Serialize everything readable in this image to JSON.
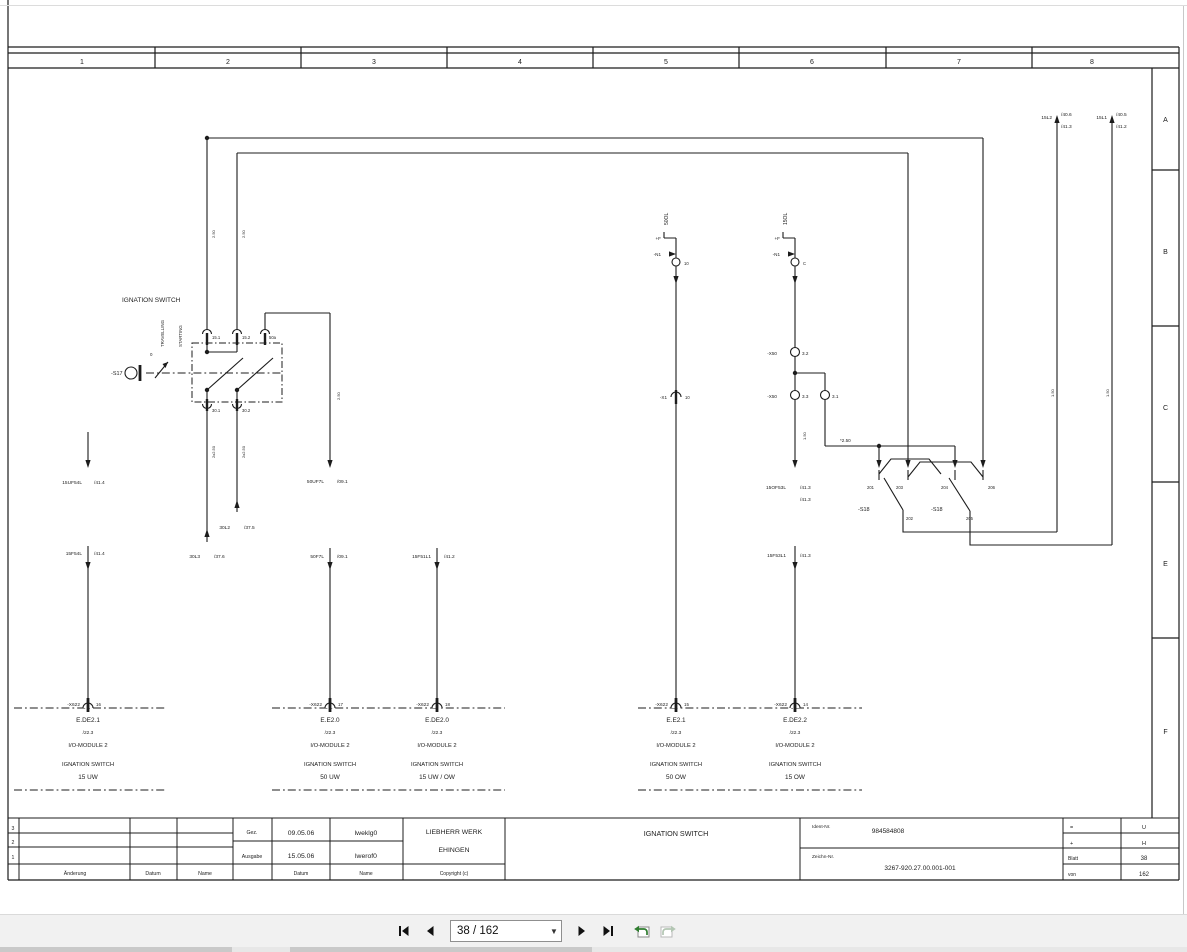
{
  "viewer": {
    "page_field": "38 / 162",
    "first_page": "first page",
    "previous_page": "previous page",
    "next_page": "next page",
    "last_page": "last page",
    "previous_view": "previous view",
    "next_view": "next view"
  },
  "frame": {
    "columns": [
      "1",
      "2",
      "3",
      "4",
      "5",
      "6",
      "7",
      "8"
    ],
    "rows": [
      "A",
      "B",
      "C",
      "E",
      "F"
    ]
  },
  "title_block": {
    "revision_rows": [
      "3",
      "2",
      "1"
    ],
    "headers": {
      "aenderung": "Änderung",
      "datum": "Datum",
      "name": "Name"
    },
    "created": {
      "label": "Gez.",
      "date": "09.05.06",
      "name": "lweklg0"
    },
    "issued": {
      "label": "Ausgabe",
      "date": "15.05.06",
      "name": "lwerof0"
    },
    "footer": {
      "datum": "Datum",
      "name": "Name",
      "copyright": "Copyright (c)"
    },
    "company": [
      "LIEBHERR WERK",
      "EHINGEN"
    ],
    "title": "IGNATION SWITCH",
    "ident": {
      "label": "Ident-Nr.",
      "value": "984584808"
    },
    "zeichn": {
      "label": "Zeichn-Nr.",
      "value": "3267-920.27.00.001-001"
    },
    "meta": [
      [
        "=",
        "U"
      ],
      [
        "+",
        "H"
      ],
      [
        "Blatt",
        "38"
      ],
      [
        "von",
        "162"
      ]
    ]
  },
  "schematic": {
    "labels": [
      {
        "n": "ignition-switch-caption",
        "t": "IGNATION SWITCH",
        "x": 122,
        "y": 302,
        "a": "l",
        "s": 6.5
      },
      {
        "n": "travelling-label",
        "t": "TRAVELLING",
        "x": 164,
        "y": 347,
        "a": "l",
        "s": 4.4,
        "r": 1
      },
      {
        "n": "starting-label",
        "t": "STARTING",
        "x": 182,
        "y": 347,
        "a": "l",
        "s": 4.4,
        "r": 1
      },
      {
        "n": "position-0-label",
        "t": "0",
        "x": 150,
        "y": 356,
        "a": "l",
        "s": 4.4
      },
      {
        "n": "s17-label",
        "t": "-S17",
        "x": 111,
        "y": 375,
        "a": "l",
        "s": 5.5
      },
      {
        "t": "15.1",
        "x": 212,
        "y": 339,
        "a": "l",
        "s": 4.2
      },
      {
        "t": "15.2",
        "x": 242,
        "y": 339,
        "a": "l",
        "s": 4.2
      },
      {
        "t": "50a",
        "x": 269,
        "y": 339,
        "a": "l",
        "s": 4.2
      },
      {
        "t": "30.1",
        "x": 212,
        "y": 412,
        "a": "l",
        "s": 4.2
      },
      {
        "t": "30.2",
        "x": 242,
        "y": 412,
        "a": "l",
        "s": 4.2
      },
      {
        "t": "2.50",
        "x": 215,
        "y": 238,
        "a": "l",
        "s": 4,
        "r": 1
      },
      {
        "t": "2.50",
        "x": 245,
        "y": 238,
        "a": "l",
        "s": 4,
        "r": 1
      },
      {
        "t": "2x2.50",
        "x": 215,
        "y": 458,
        "a": "l",
        "s": 4,
        "r": 1
      },
      {
        "t": "2x2.50",
        "x": 245,
        "y": 458,
        "a": "l",
        "s": 4,
        "r": 1
      },
      {
        "t": "2.50",
        "x": 340,
        "y": 400,
        "a": "l",
        "s": 4,
        "r": 1
      },
      {
        "t": "15UF54L",
        "x": 82,
        "y": 484,
        "a": "r",
        "s": 4.8
      },
      {
        "t": "/41.4",
        "x": 94,
        "y": 484,
        "a": "l",
        "s": 4.8
      },
      {
        "t": "15F54L",
        "x": 82,
        "y": 555,
        "a": "r",
        "s": 4.8
      },
      {
        "t": "/41.4",
        "x": 94,
        "y": 555,
        "a": "l",
        "s": 4.8
      },
      {
        "t": "30L2",
        "x": 230,
        "y": 529,
        "a": "r",
        "s": 4.8
      },
      {
        "t": "/37.5",
        "x": 244,
        "y": 529,
        "a": "l",
        "s": 4.8
      },
      {
        "t": "30L3",
        "x": 200,
        "y": 558,
        "a": "r",
        "s": 4.8
      },
      {
        "t": "/37.6",
        "x": 214,
        "y": 558,
        "a": "l",
        "s": 4.8
      },
      {
        "t": "50UF7L",
        "x": 324,
        "y": 483,
        "a": "r",
        "s": 4.8
      },
      {
        "t": "/09.1",
        "x": 337,
        "y": 483,
        "a": "l",
        "s": 4.8
      },
      {
        "t": "50F7L",
        "x": 324,
        "y": 558,
        "a": "r",
        "s": 4.8
      },
      {
        "t": "/09.1",
        "x": 337,
        "y": 558,
        "a": "l",
        "s": 4.8
      },
      {
        "t": "15F51L1",
        "x": 431,
        "y": 558,
        "a": "r",
        "s": 4.8
      },
      {
        "t": "/41.2",
        "x": 444,
        "y": 558,
        "a": "l",
        "s": 4.8
      },
      {
        "n": "wire-50ol",
        "t": "50OL",
        "x": 668,
        "y": 225,
        "a": "l",
        "s": 5,
        "r": 1
      },
      {
        "t": "+F",
        "x": 661,
        "y": 240,
        "a": "r",
        "s": 4.6
      },
      {
        "t": "-N1",
        "x": 661,
        "y": 256,
        "a": "r",
        "s": 4.6
      },
      {
        "t": "10",
        "x": 684,
        "y": 265,
        "a": "l",
        "s": 4.2
      },
      {
        "t": "-X1",
        "x": 667,
        "y": 399,
        "a": "r",
        "s": 4.6
      },
      {
        "t": "10",
        "x": 685,
        "y": 399,
        "a": "l",
        "s": 4.2
      },
      {
        "n": "wire-15ol",
        "t": "15OL",
        "x": 787,
        "y": 225,
        "a": "l",
        "s": 5,
        "r": 1
      },
      {
        "t": "+F",
        "x": 780,
        "y": 240,
        "a": "r",
        "s": 4.6
      },
      {
        "t": "-N1",
        "x": 780,
        "y": 256,
        "a": "r",
        "s": 4.6
      },
      {
        "t": "C",
        "x": 803,
        "y": 265,
        "a": "l",
        "s": 4.2
      },
      {
        "t": "-X50",
        "x": 777,
        "y": 355,
        "a": "r",
        "s": 4.6
      },
      {
        "t": "3.2",
        "x": 802,
        "y": 355,
        "a": "l",
        "s": 4.6
      },
      {
        "t": "-X50",
        "x": 777,
        "y": 398,
        "a": "r",
        "s": 4.6
      },
      {
        "t": "3.3",
        "x": 802,
        "y": 398,
        "a": "l",
        "s": 4.6
      },
      {
        "t": "3.1",
        "x": 832,
        "y": 398,
        "a": "l",
        "s": 4.6
      },
      {
        "t": "1.50",
        "x": 806,
        "y": 440,
        "a": "l",
        "s": 4,
        "r": 1
      },
      {
        "t": "15OF53L",
        "x": 786,
        "y": 489,
        "a": "r",
        "s": 4.8
      },
      {
        "t": "/41.3",
        "x": 800,
        "y": 489,
        "a": "l",
        "s": 4.8
      },
      {
        "t": "/41.3",
        "x": 800,
        "y": 501,
        "a": "l",
        "s": 4.8
      },
      {
        "t": "15F53L1",
        "x": 786,
        "y": 557,
        "a": "r",
        "s": 4.8
      },
      {
        "t": "/41.3",
        "x": 800,
        "y": 557,
        "a": "l",
        "s": 4.8
      },
      {
        "t": "*2.50",
        "x": 840,
        "y": 442,
        "a": "l",
        "s": 4.6
      },
      {
        "t": "201",
        "x": 874,
        "y": 489,
        "a": "r",
        "s": 4.2
      },
      {
        "t": "203",
        "x": 896,
        "y": 489,
        "a": "l",
        "s": 4.2
      },
      {
        "t": "204",
        "x": 941,
        "y": 489,
        "a": "l",
        "s": 4.2
      },
      {
        "t": "206",
        "x": 988,
        "y": 489,
        "a": "l",
        "s": 4.2
      },
      {
        "n": "s18-label",
        "t": "-S18",
        "x": 858,
        "y": 511,
        "a": "l",
        "s": 5.5
      },
      {
        "n": "s18-label",
        "t": "-S18",
        "x": 931,
        "y": 511,
        "a": "l",
        "s": 5.5
      },
      {
        "t": "202",
        "x": 906,
        "y": 520,
        "a": "l",
        "s": 4.2
      },
      {
        "t": "205",
        "x": 966,
        "y": 520,
        "a": "l",
        "s": 4.2
      },
      {
        "t": "15L2",
        "x": 1052,
        "y": 119,
        "a": "r",
        "s": 4.8
      },
      {
        "t": "/40.6",
        "x": 1061,
        "y": 116,
        "a": "l",
        "s": 4.8
      },
      {
        "t": "/41.3",
        "x": 1061,
        "y": 128,
        "a": "l",
        "s": 4.8
      },
      {
        "t": "15L1",
        "x": 1107,
        "y": 119,
        "a": "r",
        "s": 4.8
      },
      {
        "t": "/40.5",
        "x": 1116,
        "y": 116,
        "a": "l",
        "s": 4.8
      },
      {
        "t": "/41.2",
        "x": 1116,
        "y": 128,
        "a": "l",
        "s": 4.8
      },
      {
        "t": "1.50",
        "x": 1054,
        "y": 397,
        "a": "l",
        "s": 4,
        "r": 1
      },
      {
        "t": "1.50",
        "x": 1109,
        "y": 397,
        "a": "l",
        "s": 4,
        "r": 1
      }
    ],
    "io_modules": [
      {
        "cx": 88,
        "connector": "-X622",
        "pin": "16",
        "name": "E.DE2.1",
        "ref": "/22.3",
        "module": "I/O-MODULE 2",
        "function": "IGNATION SWITCH",
        "channel": "15 UW"
      },
      {
        "cx": 330,
        "connector": "-X622",
        "pin": "17",
        "name": "E.E2.0",
        "ref": "/22.3",
        "module": "I/O-MODULE 2",
        "function": "IGNATION SWITCH",
        "channel": "50 UW"
      },
      {
        "cx": 437,
        "connector": "-X622",
        "pin": "18",
        "name": "E.DE2.0",
        "ref": "/22.3",
        "module": "I/O-MODULE 2",
        "function": "IGNATION SWITCH",
        "channel": "15 UW / OW"
      },
      {
        "cx": 676,
        "connector": "-X622",
        "pin": "15",
        "name": "E.E2.1",
        "ref": "/22.3",
        "module": "I/O-MODULE 2",
        "function": "IGNATION SWITCH",
        "channel": "50 OW"
      },
      {
        "cx": 795,
        "connector": "-X622",
        "pin": "14",
        "name": "E.DE2.2",
        "ref": "/22.3",
        "module": "I/O-MODULE 2",
        "function": "IGNATION SWITCH",
        "channel": "15 OW"
      }
    ]
  }
}
